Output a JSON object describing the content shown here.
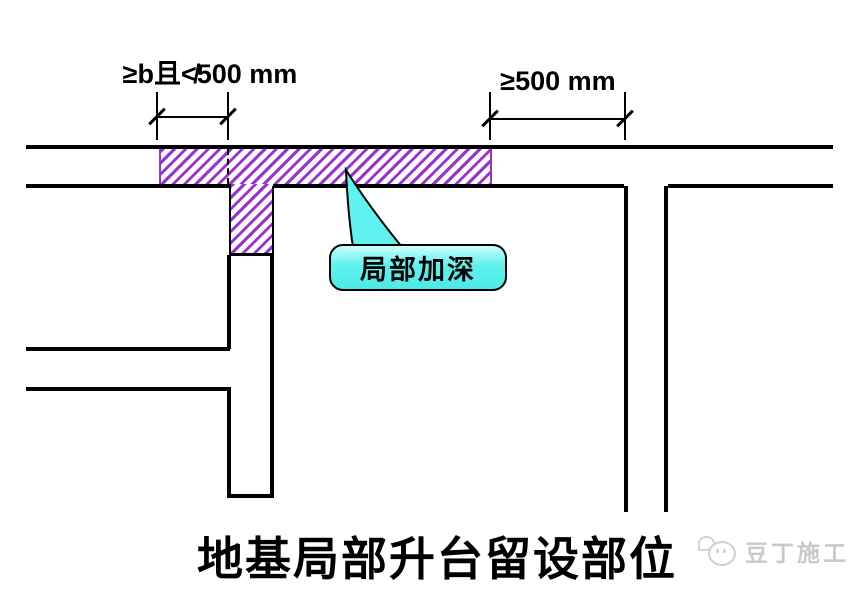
{
  "annotations": {
    "dim_left": {
      "label": "≥b且≮500 mm"
    },
    "dim_right": {
      "label": "≥500 mm"
    },
    "callout": {
      "label": "局部加深"
    },
    "title": "地基局部升台留设部位",
    "watermark": {
      "label": "豆丁施工",
      "icon": "douding-mascot-icon"
    }
  },
  "colors": {
    "line": "#000000",
    "hatch_stripe": "#9933cc",
    "callout_fill": "#5ff2ee",
    "callout_border": "#000000",
    "watermark_gray": "#c9c9c9"
  }
}
